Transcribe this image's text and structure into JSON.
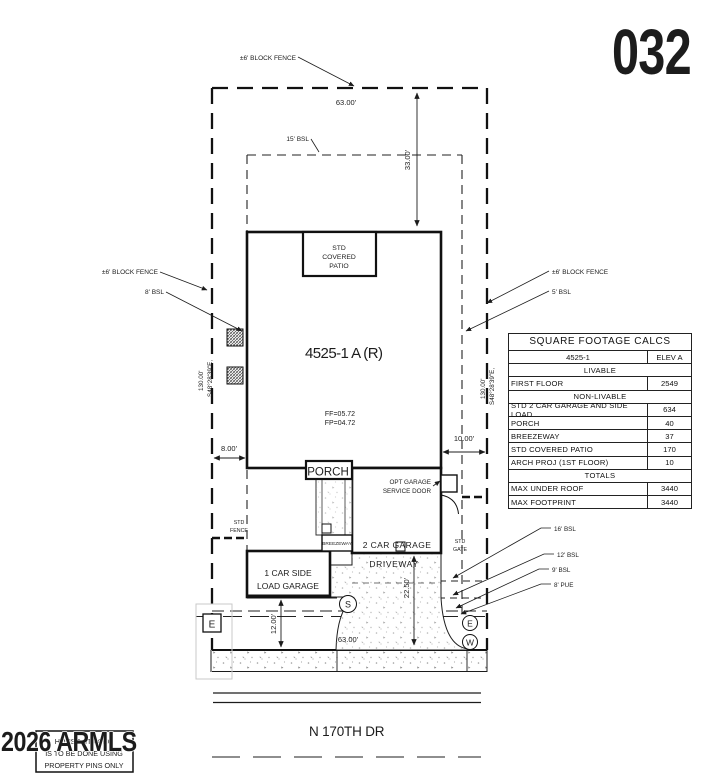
{
  "page": {
    "sheet_number": "032",
    "watermark": "2026 ARMLS"
  },
  "note": {
    "line1": "HOUSE STAKING",
    "line2": "IS TO BE DONE USING",
    "line3": "PROPERTY PINS ONLY"
  },
  "street": {
    "name": "N 170TH DR"
  },
  "plan": {
    "model": "4525-1 A (R)",
    "ff": "FF=05.72",
    "fp": "FP=04.72",
    "patio_l1": "STD",
    "patio_l2": "COVERED",
    "patio_l3": "PATIO",
    "porch": "PORCH",
    "breezeway": "BREEZEWAY",
    "garage2": "2 CAR GARAGE",
    "garage1_l1": "1 CAR SIDE",
    "garage1_l2": "LOAD GARAGE",
    "driveway": "DRIVEWAY",
    "opt_door_l1": "OPT GARAGE",
    "opt_door_l2": "SERVICE DOOR",
    "gate_l1": "STD",
    "gate_l2": "GATE",
    "fence_sm_l1": "STD",
    "fence_sm_l2": "FENCE",
    "fence_top": "±6' BLOCK FENCE",
    "fence_left": "±6' BLOCK FENCE",
    "fence_right": "±6' BLOCK FENCE",
    "bsl15": "15' BSL",
    "bsl8": "8' BSL",
    "bsl5": "5' BSL",
    "bsl16": "16' BSL",
    "bsl12": "12' BSL",
    "bsl9": "9' BSL",
    "pue8": "8' PUE",
    "dim_width_rear": "63.00'",
    "dim_width_front": "63.00'",
    "dim_33": "33.00'",
    "dim_8": "8.00'",
    "dim_10": "10.00'",
    "dim_12": "12.00'",
    "dim_225": "22.50'",
    "bearing_left_1": "S48°28'39\"E,",
    "bearing_left_2": "130.00'",
    "bearing_right_1": "S48°28'39\"E,",
    "bearing_right_2": "130.00'",
    "marker_s": "S",
    "marker_e_box": "E",
    "marker_e": "E",
    "marker_w": "W"
  },
  "table": {
    "title": "SQUARE FOOTAGE CALCS",
    "model": "4525-1",
    "elev": "ELEV A",
    "sec_livable": "LIVABLE",
    "rows_livable": [
      {
        "label": "FIRST FLOOR",
        "value": "2549"
      }
    ],
    "sec_nonlivable": "NON-LIVABLE",
    "rows_nonlivable": [
      {
        "label": "STD 2 CAR GARAGE AND SIDE LOAD",
        "value": "634"
      },
      {
        "label": "PORCH",
        "value": "40"
      },
      {
        "label": "BREEZEWAY",
        "value": "37"
      },
      {
        "label": "STD COVERED PATIO",
        "value": "170"
      },
      {
        "label": "ARCH PROJ (1ST FLOOR)",
        "value": "10"
      }
    ],
    "sec_totals": "TOTALS",
    "rows_totals": [
      {
        "label": "MAX UNDER ROOF",
        "value": "3440"
      },
      {
        "label": "MAX FOOTPRINT",
        "value": "3440"
      }
    ]
  }
}
